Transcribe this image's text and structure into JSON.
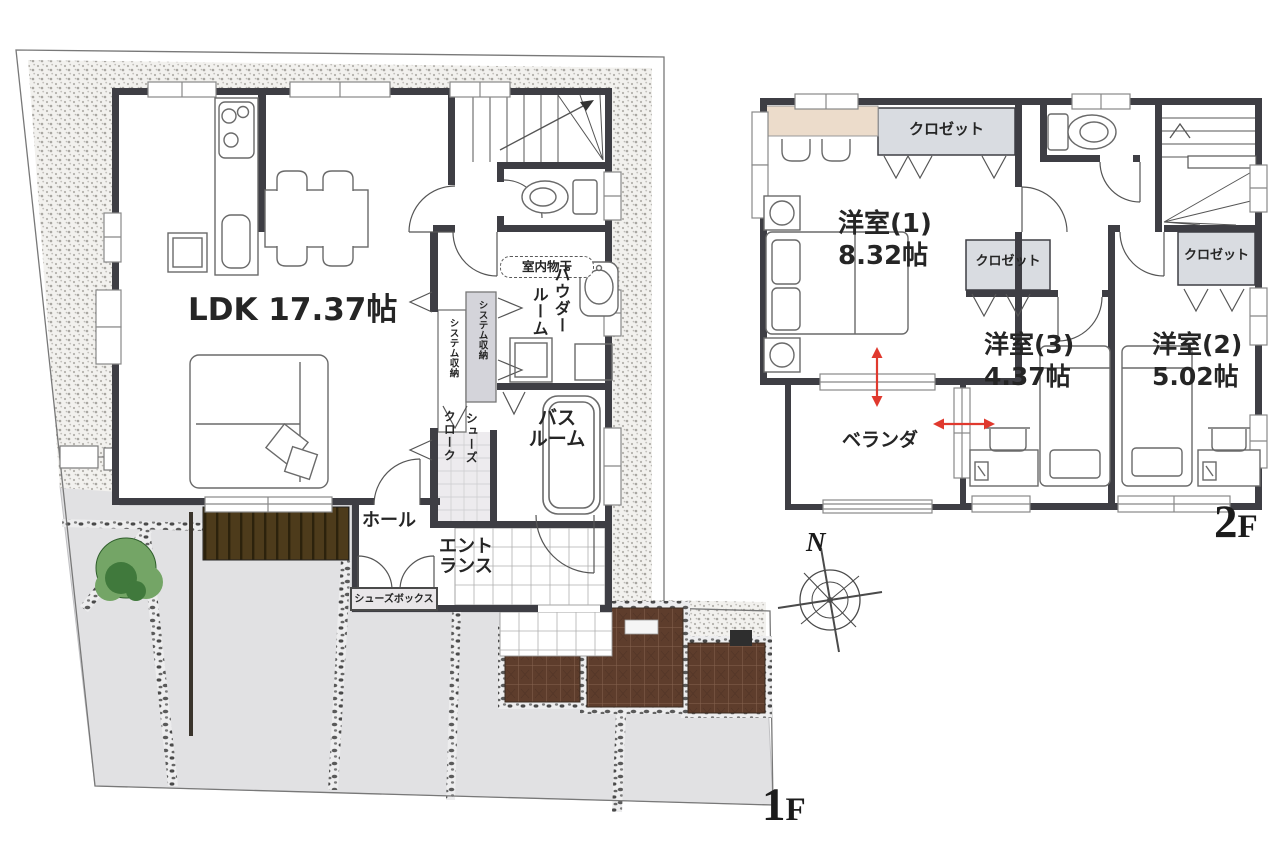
{
  "floor1": {
    "floor_label": "1F",
    "ldk_label": "LDK 17.37帖",
    "hall_label": "ホール",
    "entrance_line1": "エント",
    "entrance_line2": "ランス",
    "shoes_box_label": "シューズボックス",
    "indoor_drying_label": "室内物干",
    "powder_room_line1": "パウダー",
    "powder_room_line2": "ルーム",
    "bath_line1": "バス",
    "bath_line2": "ルーム",
    "system_storage_left": "システム収納",
    "system_storage_right": "システム収納",
    "shoe_closet_line1": "シューズ",
    "shoe_closet_line2": "クローク"
  },
  "floor2": {
    "floor_label": "2F",
    "room1_name": "洋室(1)",
    "room1_size": "8.32帖",
    "room2_name": "洋室(2)",
    "room2_size": "5.02帖",
    "room3_name": "洋室(3)",
    "room3_size": "4.37帖",
    "closet_label_room1": "クロゼット",
    "closet_label_room2": "クロゼット",
    "closet_label_room3": "クロゼット",
    "veranda_label": "ベランダ"
  },
  "compass": {
    "north_label": "N"
  },
  "colors": {
    "wall": "#3e3e44",
    "closet_fill": "#d9dce1",
    "counter_beige": "#ecdccb",
    "deck_brown": "#4d3b1b",
    "tile_brown": "#5e3d2c",
    "pavement_gray": "#e1e1e3",
    "tree_green": "#4a8045",
    "arrow_red": "#e0392e"
  }
}
